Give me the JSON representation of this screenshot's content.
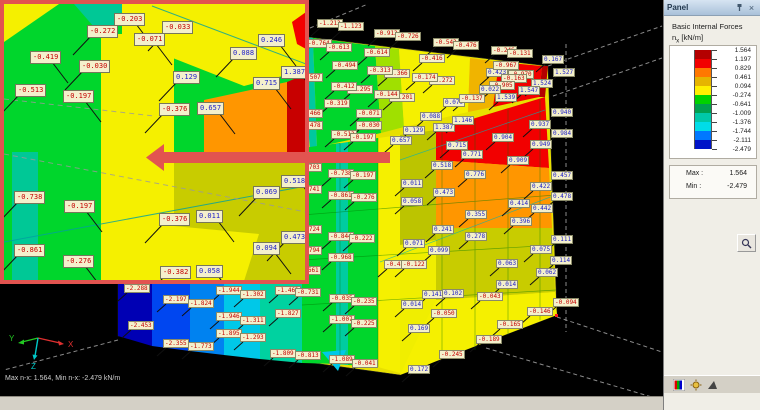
{
  "viewport": {
    "status_text": "Max n-x: 1.564, Min n-x: -2.479 kN/m",
    "axes": {
      "x": "X",
      "y": "Y",
      "z": "Z"
    },
    "axis_colors": {
      "x": "#e03030",
      "y": "#22c822",
      "z": "#00c8c8"
    },
    "callout_color": "#e25450"
  },
  "model": {
    "labels_xyv": [
      [
        317,
        19,
        "-1.213"
      ],
      [
        338,
        22,
        "-1.123"
      ],
      [
        374,
        29,
        "-0.913"
      ],
      [
        395,
        32,
        "-0.726"
      ],
      [
        306,
        39,
        "-0.764"
      ],
      [
        326,
        43,
        "-0.613"
      ],
      [
        433,
        38,
        "-0.543"
      ],
      [
        453,
        41,
        "-0.476"
      ],
      [
        364,
        48,
        "-0.614"
      ],
      [
        419,
        54,
        "-0.416"
      ],
      [
        332,
        61,
        "-0.494"
      ],
      [
        384,
        69,
        "-0.366"
      ],
      [
        367,
        66,
        "-0.313"
      ],
      [
        429,
        76,
        "-0.272"
      ],
      [
        412,
        73,
        "-0.174"
      ],
      [
        297,
        73,
        "-0.507"
      ],
      [
        347,
        85,
        "-0.295"
      ],
      [
        331,
        82,
        "-0.412"
      ],
      [
        389,
        93,
        "-0.201"
      ],
      [
        374,
        90,
        "-0.144"
      ],
      [
        443,
        98,
        "0.079"
      ],
      [
        459,
        94,
        "-0.137"
      ],
      [
        324,
        99,
        "-0.319"
      ],
      [
        297,
        109,
        "-0.466"
      ],
      [
        356,
        109,
        "-0.071"
      ],
      [
        420,
        112,
        "0.088"
      ],
      [
        433,
        123,
        "1.387"
      ],
      [
        452,
        116,
        "1.146"
      ],
      [
        356,
        121,
        "-0.030"
      ],
      [
        297,
        121,
        "-0.478"
      ],
      [
        403,
        126,
        "0.129"
      ],
      [
        331,
        130,
        "-0.513"
      ],
      [
        350,
        133,
        "-0.197"
      ],
      [
        390,
        136,
        "0.657"
      ],
      [
        446,
        141,
        "0.715"
      ],
      [
        491,
        46,
        "-0.246"
      ],
      [
        507,
        49,
        "-0.131"
      ],
      [
        542,
        55,
        "0.167"
      ],
      [
        553,
        68,
        "1.527"
      ],
      [
        486,
        68,
        "0.423"
      ],
      [
        493,
        61,
        "-0.967"
      ],
      [
        508,
        70,
        "-0.970"
      ],
      [
        501,
        74,
        "-0.163"
      ],
      [
        531,
        79,
        "1.524"
      ],
      [
        518,
        86,
        "1.547"
      ],
      [
        489,
        81,
        "-0.905"
      ],
      [
        479,
        85,
        "0.022"
      ],
      [
        495,
        93,
        "1.539"
      ],
      [
        551,
        108,
        "0.940"
      ],
      [
        529,
        120,
        "0.937"
      ],
      [
        551,
        129,
        "0.984"
      ],
      [
        492,
        133,
        "0.904"
      ],
      [
        530,
        140,
        "0.949"
      ],
      [
        507,
        156,
        "0.909"
      ],
      [
        551,
        171,
        "0.457"
      ],
      [
        530,
        182,
        "0.422"
      ],
      [
        551,
        192,
        "0.478"
      ],
      [
        508,
        199,
        "0.414"
      ],
      [
        531,
        204,
        "0.442"
      ],
      [
        510,
        217,
        "0.396"
      ],
      [
        551,
        235,
        "0.111"
      ],
      [
        530,
        245,
        "0.075"
      ],
      [
        550,
        256,
        "0.114"
      ],
      [
        461,
        150,
        "0.771"
      ],
      [
        431,
        161,
        "0.518"
      ],
      [
        464,
        170,
        "0.776"
      ],
      [
        401,
        179,
        "0.011"
      ],
      [
        433,
        188,
        "0.473"
      ],
      [
        401,
        197,
        "0.058"
      ],
      [
        465,
        210,
        "0.355"
      ],
      [
        432,
        225,
        "0.241"
      ],
      [
        465,
        232,
        "0.278"
      ],
      [
        403,
        239,
        "0.071"
      ],
      [
        428,
        246,
        "0.099"
      ],
      [
        296,
        163,
        "-0.703"
      ],
      [
        296,
        185,
        "-0.741"
      ],
      [
        296,
        225,
        "-0.724"
      ],
      [
        296,
        246,
        "-0.794"
      ],
      [
        328,
        169,
        "-0.738"
      ],
      [
        350,
        171,
        "-0.197"
      ],
      [
        328,
        191,
        "-0.861"
      ],
      [
        351,
        193,
        "-0.276"
      ],
      [
        328,
        232,
        "-0.844"
      ],
      [
        349,
        234,
        "-0.222"
      ],
      [
        328,
        253,
        "-0.968"
      ],
      [
        124,
        284,
        "-2.288"
      ],
      [
        128,
        321,
        "-2.453"
      ],
      [
        163,
        295,
        "-2.197"
      ],
      [
        188,
        299,
        "-1.824"
      ],
      [
        163,
        339,
        "-2.355"
      ],
      [
        188,
        342,
        "-1.773"
      ],
      [
        216,
        286,
        "-1.944"
      ],
      [
        240,
        290,
        "-1.302"
      ],
      [
        216,
        312,
        "-1.946"
      ],
      [
        240,
        316,
        "-1.311"
      ],
      [
        216,
        329,
        "-1.895"
      ],
      [
        240,
        333,
        "-1.293"
      ],
      [
        275,
        286,
        "-1.463"
      ],
      [
        295,
        266,
        "-0.661"
      ],
      [
        275,
        309,
        "-1.827"
      ],
      [
        295,
        288,
        "-0.731"
      ],
      [
        270,
        349,
        "-1.809"
      ],
      [
        295,
        351,
        "-0.813"
      ],
      [
        329,
        294,
        "-0.035"
      ],
      [
        351,
        297,
        "-0.235"
      ],
      [
        329,
        315,
        "-1.007"
      ],
      [
        351,
        319,
        "-0.225"
      ],
      [
        329,
        355,
        "-1.089"
      ],
      [
        352,
        359,
        "-0.041"
      ],
      [
        384,
        260,
        "-0.437"
      ],
      [
        401,
        260,
        "-0.122"
      ],
      [
        401,
        300,
        "0.014"
      ],
      [
        422,
        290,
        "0.141"
      ],
      [
        442,
        289,
        "0.102"
      ],
      [
        431,
        309,
        "-0.050"
      ],
      [
        408,
        324,
        "0.169"
      ],
      [
        439,
        350,
        "-0.245"
      ],
      [
        408,
        365,
        "0.172"
      ],
      [
        496,
        259,
        "0.063"
      ],
      [
        536,
        268,
        "0.062"
      ],
      [
        496,
        280,
        "0.014"
      ],
      [
        553,
        298,
        "-0.094"
      ],
      [
        527,
        307,
        "-0.146"
      ],
      [
        497,
        320,
        "-0.165"
      ],
      [
        477,
        292,
        "-0.043"
      ],
      [
        476,
        335,
        "-0.189"
      ]
    ]
  },
  "inset": {
    "labels_xyv": [
      [
        110,
        9,
        "-0.203"
      ],
      [
        83,
        21,
        "-0.272"
      ],
      [
        130,
        29,
        "-0.071"
      ],
      [
        158,
        17,
        "-0.033"
      ],
      [
        254,
        30,
        "0.246"
      ],
      [
        226,
        43,
        "0.088"
      ],
      [
        26,
        47,
        "-0.419"
      ],
      [
        75,
        56,
        "-0.030"
      ],
      [
        277,
        62,
        "1.387"
      ],
      [
        169,
        67,
        "0.129"
      ],
      [
        249,
        73,
        "0.715"
      ],
      [
        11,
        80,
        "-0.513"
      ],
      [
        59,
        86,
        "-0.197"
      ],
      [
        155,
        99,
        "-0.376"
      ],
      [
        193,
        98,
        "0.657"
      ],
      [
        10,
        187,
        "-0.738"
      ],
      [
        60,
        196,
        "-0.197"
      ],
      [
        10,
        240,
        "-0.861"
      ],
      [
        59,
        251,
        "-0.276"
      ],
      [
        155,
        209,
        "-0.376"
      ],
      [
        192,
        206,
        "0.011"
      ],
      [
        249,
        182,
        "0.069"
      ],
      [
        277,
        171,
        "0.518"
      ],
      [
        277,
        227,
        "0.473"
      ],
      [
        249,
        238,
        "0.094"
      ],
      [
        156,
        262,
        "-0.382"
      ],
      [
        192,
        261,
        "0.058"
      ]
    ]
  },
  "panel": {
    "title": "Panel",
    "result_title": "Basic Internal Forces",
    "quantity": "n",
    "quantity_sub": "x",
    "unit": "[kN/m]",
    "scale": {
      "ticks": [
        "1.564",
        "1.197",
        "0.829",
        "0.461",
        "0.094",
        "-0.274",
        "-0.641",
        "-1.009",
        "-1.376",
        "-1.744",
        "-2.111",
        "-2.479"
      ],
      "colors": [
        "#b40000",
        "#f20000",
        "#ff7800",
        "#e6b400",
        "#fff000",
        "#00d200",
        "#00a050",
        "#00c8a8",
        "#00dce8",
        "#0078ff",
        "#0014c8"
      ]
    },
    "max_label": "Max :",
    "max_value": "1.564",
    "min_label": "Min :",
    "min_value": "-2.479"
  }
}
